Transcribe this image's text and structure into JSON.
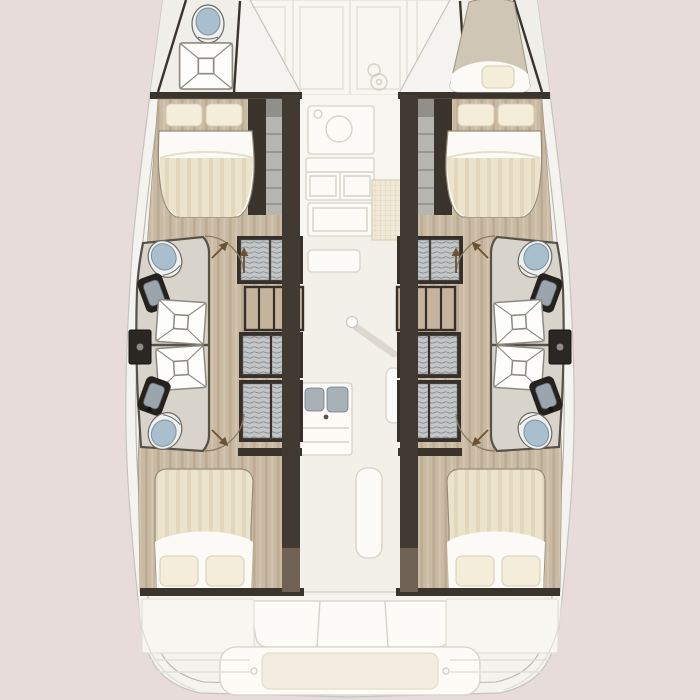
{
  "image": {
    "width": 700,
    "height": 700,
    "kind": "yacht-floorplan",
    "description": "Top-down interior layout plan of a sailing catamaran: two symmetrical hulls each with a forward double cabin, two back-to-back bathrooms (toilet, washbasin, shower) and an aft double cabin; port bow holds a small head with toilet and shower, starboard bow holds a single berth; central nacelle with galley, saloon, mast post and sink unit plus fore and aft cockpits shown faded"
  },
  "colors": {
    "bg": "#e7dcd9",
    "hull": "#f4f3ef",
    "hull_line": "#c6c3bc",
    "deck_line": "#b9b6b0",
    "faded_fill": "#f8f6f1",
    "faded_fill2": "#f3f0e9",
    "faded_line": "#e3dfd6",
    "faded_line2": "#d6d2c7",
    "cushion": "#f2edde",
    "wood": "#c9baa4",
    "wood_dark": "#bcab92",
    "wood_light": "#d5c8b4",
    "wood_line": "#9b8c76",
    "wall": "#3b342d",
    "wall_tan": "#6f6254",
    "bath_floor": "#d8d4cc",
    "bath_line": "#565149",
    "gray_steps": "#b7b5b0",
    "locker_frame": "#37302a",
    "locker_fill": "#c3c6c7",
    "locker_line": "#80848a",
    "shelf": "#c4b49e",
    "bed_white": "#fbfaf6",
    "bed_cream": "#ece3cd",
    "bed_stripe": "#e2d7bd",
    "pillow": "#f3edda",
    "pillow_line": "#d8cfb6",
    "bed_line": "#958d79",
    "toilet_lid": "#a9bfce",
    "toilet_rim": "#eff1f1",
    "fixture_line": "#6e6a64",
    "sink_body": "#25211d",
    "sink_basin": "#9aa5ae",
    "shower_fill": "#fdfdfb",
    "shower_line": "#8f8a80",
    "door_arc": "#8a7a5f",
    "door_arrow": "#6b5335",
    "dark_box": "#2b2723",
    "berth_top": "#d0c6b5"
  },
  "floorplan": {
    "orientation": "bow-up",
    "description": "Catamaran layout plan: 4 guest double cabins, 4 bathrooms, bow head and bow berth, saloon / galley / cockpits faded",
    "labels": {
      "boat_outline": "Catamaran hull outline",
      "port_hull": "Port hull: forward double cabin, two bathrooms, aft double cabin",
      "starboard_hull": "Starboard hull (mirror of port hull)",
      "port_bow_head": "Port bow head with toilet and shower",
      "starboard_bow_berth": "Starboard bow single berth",
      "forward_doors": "Forward saloon door front (faded)",
      "galley": "Galley with stove, cabinets and floor hatch (faded)",
      "saloon": "Saloon floor with mast post (faded)",
      "sink_unit": "Central double-bowl sink unit (faded)",
      "aft_cockpit": "Aft cockpit with bench seat and platform cushion (faded)"
    },
    "counts": {
      "guest_cabins": 4,
      "bathrooms": 4,
      "toilets": 5,
      "showers": 5,
      "bathroom_sinks": 4,
      "galley_sink_bowls": 2,
      "double_beds": 4,
      "single_berths": 1,
      "hanging_lockers_per_hull": 3,
      "shelf_units_per_hull": 1,
      "door_swings_per_hull": 2,
      "mast_posts": 1
    },
    "legend": [
      {
        "icon": "toilet-icon",
        "meaning": "marine toilet (white rim, blue-grey lid)"
      },
      {
        "icon": "shower-icon",
        "meaning": "shower tray (square with X fold lines)"
      },
      {
        "icon": "sink-icon",
        "meaning": "washbasin (dark counter, grey bowl)"
      },
      {
        "icon": "bed-icon",
        "meaning": "double berth with pillows and striped duvet"
      },
      {
        "icon": "hanging-locker-icon",
        "meaning": "wardrobe with hanging clothes (ripple stripes)"
      },
      {
        "icon": "shelf-unit-icon",
        "meaning": "shelved locker (tan with dividers)"
      },
      {
        "icon": "door-swing-icon",
        "meaning": "door with swing arc and arrow"
      },
      {
        "icon": "mast-post-icon",
        "meaning": "mast compression post with shadow"
      }
    ]
  }
}
